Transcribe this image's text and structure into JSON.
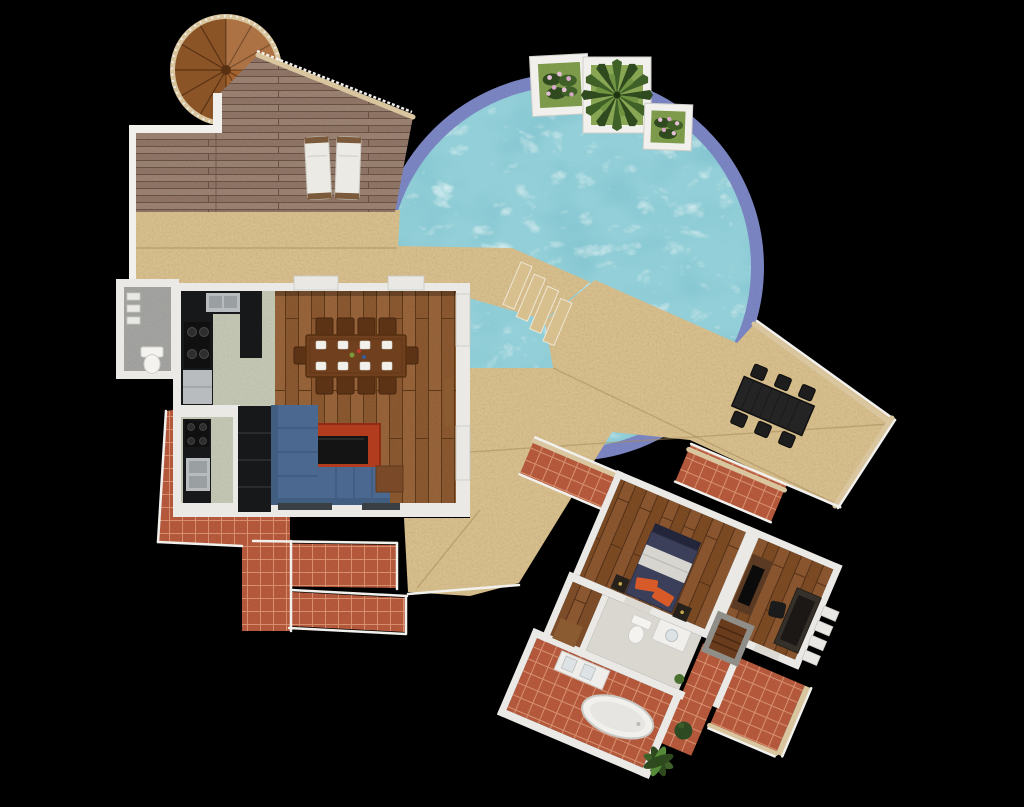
{
  "scene": {
    "title": "villa-floorplan-3d-render",
    "view": "top-down orthographic",
    "background": "#000000"
  },
  "palette": {
    "sand": "#d8bf8e",
    "sand_line": "#a98e5e",
    "pool_water": "#93cfd8",
    "pool_border": "#7a85c2",
    "trim_tan": "#d9c59e",
    "railing": "#f1f0ec",
    "wall": "#eae9e5",
    "deck_a": "#8f7566",
    "deck_b": "#9a8172",
    "deck_line": "#6a5244",
    "terra": "#b65a3e",
    "terra_line": "#d9916f",
    "wood_a": "#8a5832",
    "wood_b": "#96643a",
    "wood_line": "#5f3a1c",
    "wing_a": "#7c4b27",
    "wing_b": "#8a5730",
    "wing_line": "#53301a",
    "kitchen_floor": "#c2c6b2",
    "wc_floor": "#a3a3a0",
    "corridor_floor": "#dad7d0",
    "grass": "#7f9c4e",
    "grass2": "#8aa855",
    "palm_dark": "#2f4a1e",
    "palm_mid": "#3f6128",
    "flower_pink": "#e3bfd7",
    "sofa_blue": "#4a6890",
    "sofa_dark": "#415d80",
    "rug_red": "#b23c1e",
    "table_wood": "#6f3f1e",
    "chair_wood": "#5d3315",
    "bed_navy": "#3b3f5a",
    "bed_grey": "#d6d5d0",
    "pillow_orange": "#d85a28",
    "black_furniture": "#17181a",
    "stainless": "#b8bcbe",
    "tub_white": "#f1f0ec",
    "concrete": "#8f8e89",
    "door_wood": "#8a5a30",
    "glass_dark": "#3a3f44",
    "stair_wood": "#a4632e"
  },
  "areas": {
    "roof_deck": {
      "name": "roof deck",
      "items": [
        "spiral-staircase",
        "sun-lounger",
        "sun-lounger"
      ]
    },
    "pool": {
      "name": "circular swimming pool",
      "planters": [
        "flower-planter",
        "palm-planter",
        "flower-planter"
      ],
      "steps_count": 4
    },
    "terrace": {
      "name": "sand terrace",
      "items": [
        "outdoor-dining-table"
      ],
      "outdoor_chairs_count": 6
    },
    "living_block": {
      "name": "main living block",
      "rooms": [
        "kitchen",
        "utility-kitchen",
        "wc",
        "living-dining-room"
      ],
      "items": [
        "dining-table",
        "dining-chairs x10",
        "plates x8",
        "sofa-L",
        "rug",
        "coffee-table",
        "side-table",
        "bookcase",
        "sink",
        "stove x2",
        "dishwasher",
        "toilet"
      ]
    },
    "bedroom_wing": {
      "name": "bedroom wing (rotated)",
      "rooms": [
        "bedroom",
        "study",
        "closet",
        "corridor",
        "bathroom",
        "tiled-patios"
      ],
      "items": [
        "double-bed",
        "nightstand x2",
        "tv-cabinet",
        "desk",
        "desk-chair",
        "stairs-down",
        "toilet",
        "vanity",
        "bathtub",
        "plant",
        "shrub"
      ]
    }
  }
}
